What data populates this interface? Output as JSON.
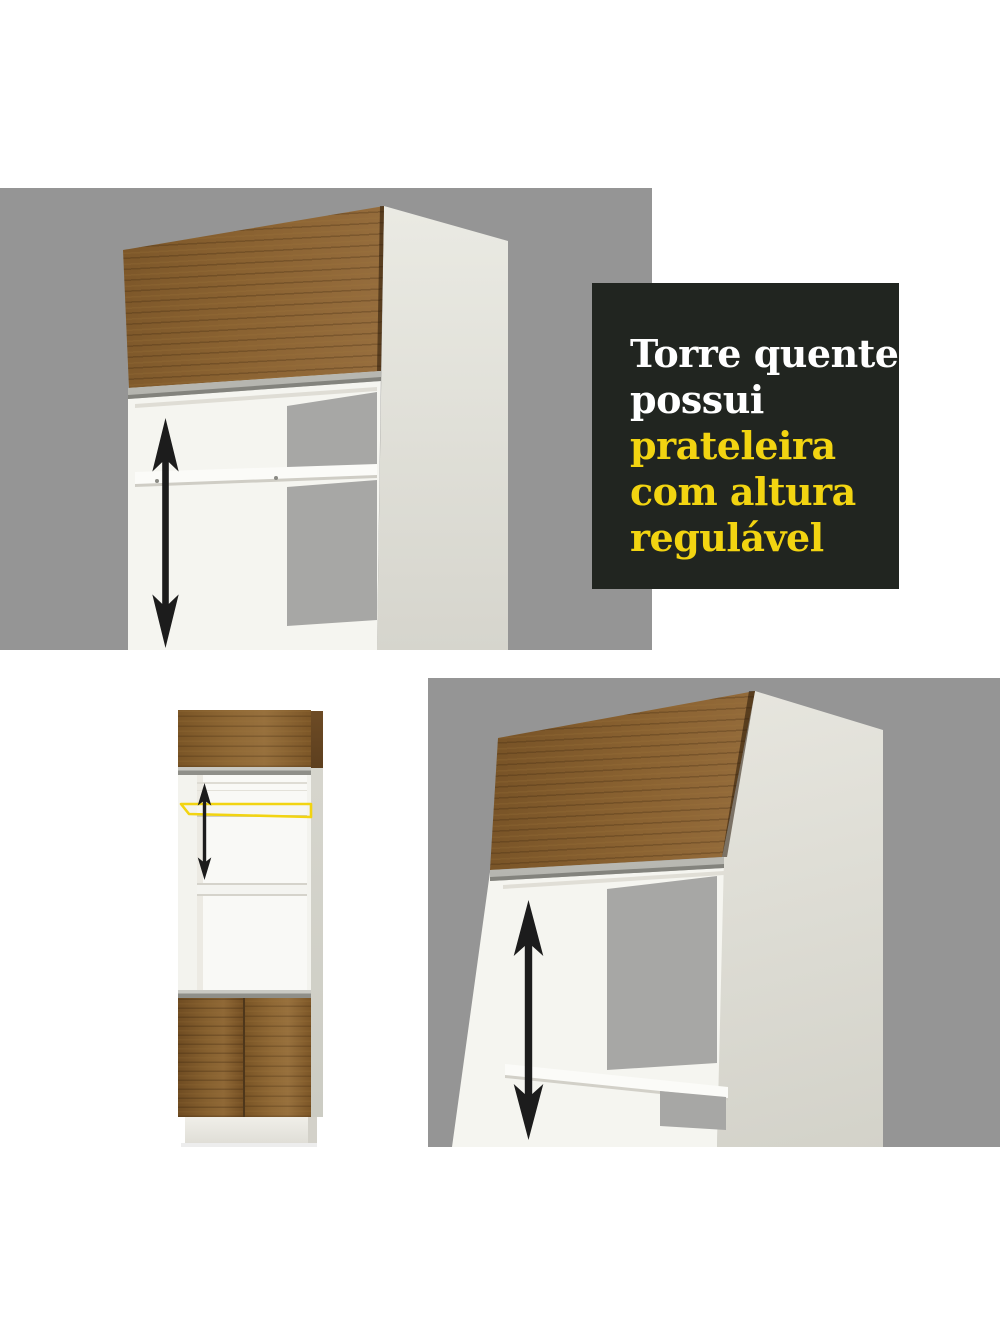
{
  "title_panel": {
    "background": "#212520",
    "lines": [
      {
        "text": "Torre quente",
        "highlight": false
      },
      {
        "text": "possui",
        "highlight": false
      },
      {
        "text": "prateleira",
        "highlight": true
      },
      {
        "text": "com altura",
        "highlight": true
      },
      {
        "text": "regulável",
        "highlight": true
      }
    ],
    "text_color": "#ffffff",
    "highlight_color": "#f2d411"
  },
  "colors": {
    "page_background": "#ffffff",
    "panel_gray": "#959595",
    "niche_opening_gray": "#a7a7a5",
    "wood_brown": "#8a6232",
    "wood_dark": "#5e401e",
    "aluminum_profile": "#b9b9b3",
    "cabinet_white": "#f5f5f0",
    "cabinet_side": "#dcdbd3",
    "arrow_black": "#1c1c1c",
    "shelf_highlight_yellow": "#f2d411"
  }
}
